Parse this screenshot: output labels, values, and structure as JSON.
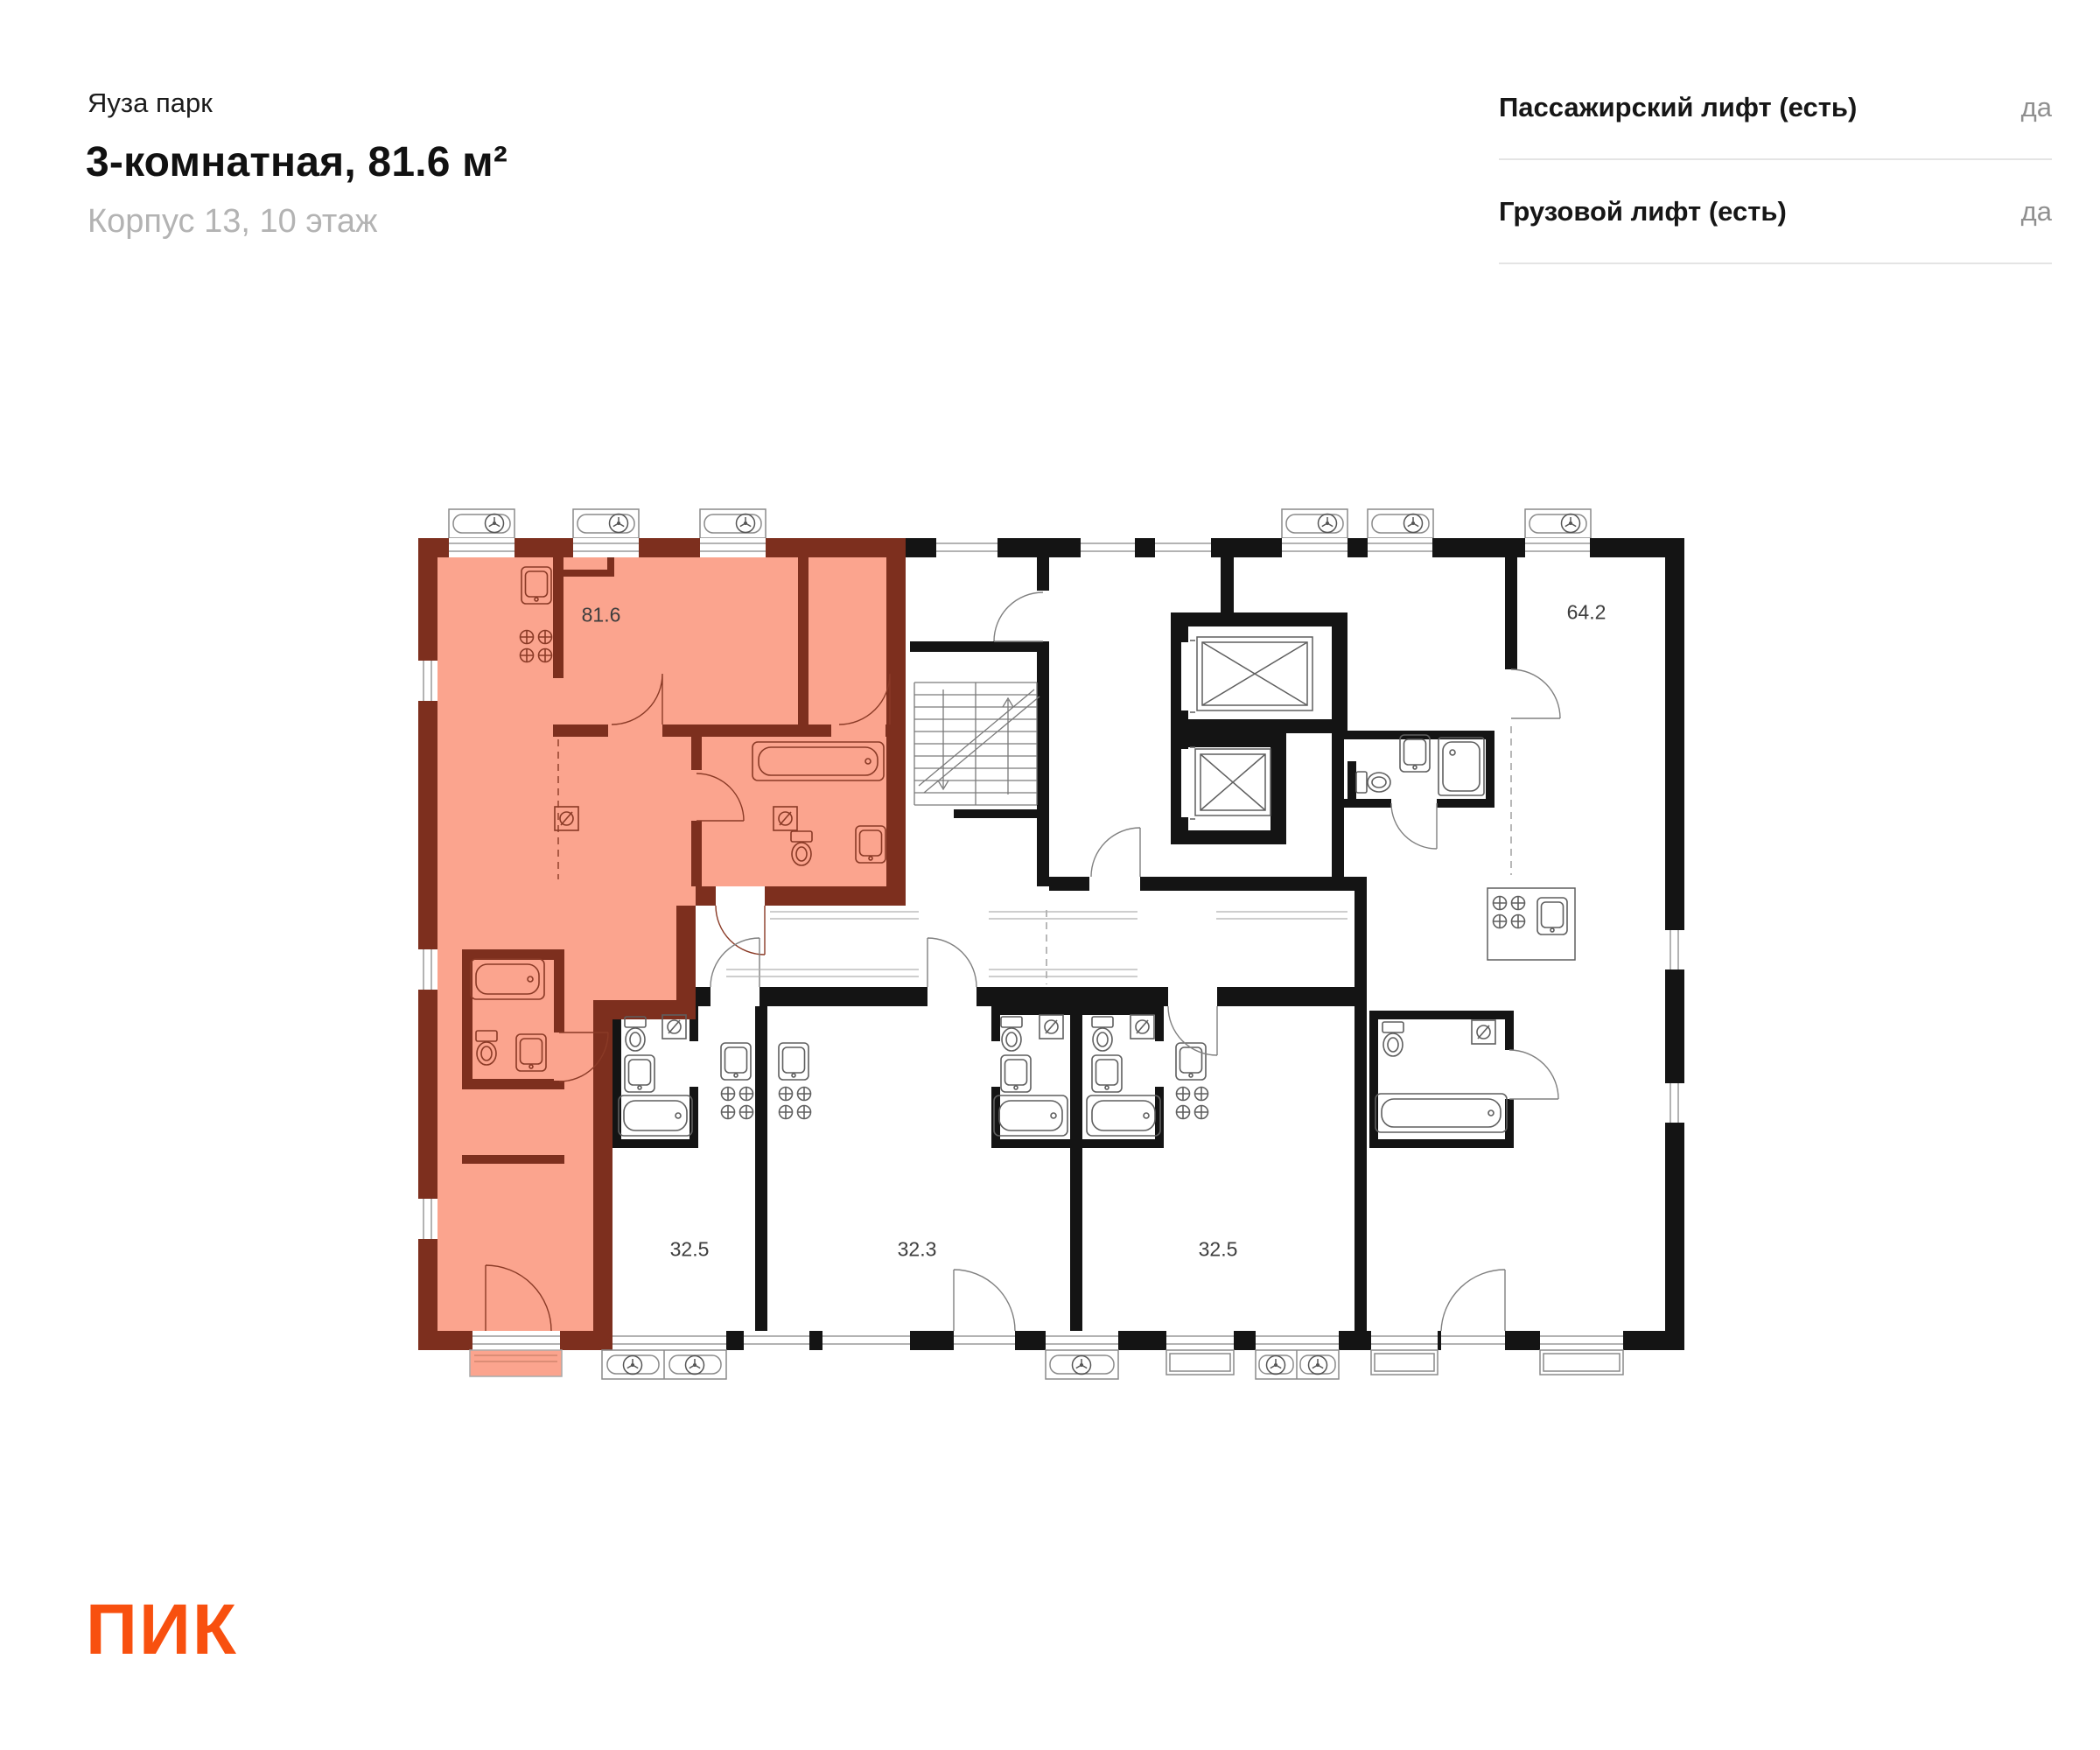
{
  "header": {
    "project_name": "Яуза парк",
    "apartment_title": "3-комнатная, 81.6 м²",
    "location_subtitle": "Корпус 13, 10 этаж"
  },
  "amenities": {
    "rows": [
      {
        "label": "Пассажирский лифт (есть)",
        "value": "да"
      },
      {
        "label": "Грузовой лифт (есть)",
        "value": "да"
      }
    ]
  },
  "floor_plan": {
    "highlighted_unit": {
      "area_label": "81.6"
    },
    "other_units": [
      {
        "area_label": "64.2"
      },
      {
        "area_label": "32.5"
      },
      {
        "area_label": "32.3"
      },
      {
        "area_label": "32.5"
      }
    ],
    "highlight_fill": "#fba48e",
    "highlight_wall_color": "#7d2f1e",
    "wall_color": "#141414"
  },
  "footer": {
    "logo_text": "ПИК",
    "logo_color": "#f8500f"
  }
}
